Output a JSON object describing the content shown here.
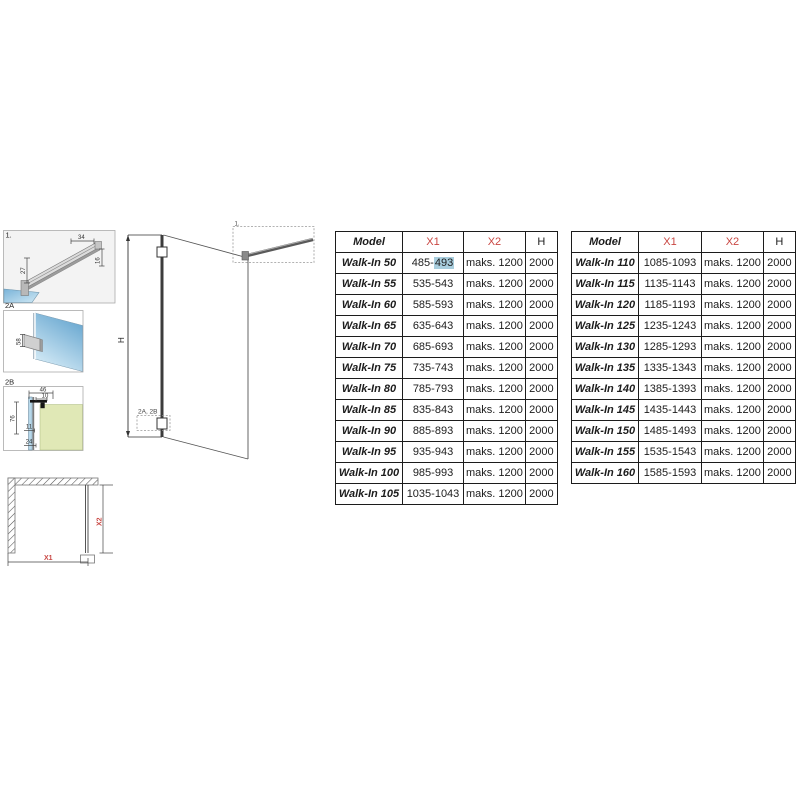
{
  "colors": {
    "dim_red": "#c94743",
    "selection_blue": "#a9cede",
    "glass_dark": "#5f9fca",
    "glass_light": "#d9eef8",
    "wall_green": "#e0e8b6",
    "panel_gray": "#f3f3f3"
  },
  "diagrams": {
    "detail1": {
      "label": "1.",
      "dim_top": "34",
      "dim_right": "16",
      "dim_left": "27"
    },
    "detail2a": {
      "label": "2A",
      "dim": "58"
    },
    "detail2b": {
      "label": "2B",
      "dim_width": "46",
      "dim_offset": "10",
      "dim_height": "76",
      "dim_glass": "11",
      "dim_bottom": "24"
    },
    "elevation": {
      "height_label": "H",
      "callout_top": "1.",
      "callout_bottom": "2A, 2B"
    },
    "plan": {
      "width_label": "X1",
      "depth_label": "X2"
    }
  },
  "tables": [
    {
      "headers": [
        "Model",
        "X1",
        "X2",
        "H"
      ],
      "rows": [
        [
          "Walk-In 50",
          "485-493",
          "maks. 1200",
          "2000"
        ],
        [
          "Walk-In 55",
          "535-543",
          "maks. 1200",
          "2000"
        ],
        [
          "Walk-In 60",
          "585-593",
          "maks. 1200",
          "2000"
        ],
        [
          "Walk-In 65",
          "635-643",
          "maks. 1200",
          "2000"
        ],
        [
          "Walk-In 70",
          "685-693",
          "maks. 1200",
          "2000"
        ],
        [
          "Walk-In 75",
          "735-743",
          "maks. 1200",
          "2000"
        ],
        [
          "Walk-In 80",
          "785-793",
          "maks. 1200",
          "2000"
        ],
        [
          "Walk-In 85",
          "835-843",
          "maks. 1200",
          "2000"
        ],
        [
          "Walk-In 90",
          "885-893",
          "maks. 1200",
          "2000"
        ],
        [
          "Walk-In 95",
          "935-943",
          "maks. 1200",
          "2000"
        ],
        [
          "Walk-In 100",
          "985-993",
          "maks. 1200",
          "2000"
        ],
        [
          "Walk-In 105",
          "1035-1043",
          "maks. 1200",
          "2000"
        ]
      ]
    },
    {
      "headers": [
        "Model",
        "X1",
        "X2",
        "H"
      ],
      "rows": [
        [
          "Walk-In 110",
          "1085-1093",
          "maks. 1200",
          "2000"
        ],
        [
          "Walk-In 115",
          "1135-1143",
          "maks. 1200",
          "2000"
        ],
        [
          "Walk-In 120",
          "1185-1193",
          "maks. 1200",
          "2000"
        ],
        [
          "Walk-In 125",
          "1235-1243",
          "maks. 1200",
          "2000"
        ],
        [
          "Walk-In 130",
          "1285-1293",
          "maks. 1200",
          "2000"
        ],
        [
          "Walk-In 135",
          "1335-1343",
          "maks. 1200",
          "2000"
        ],
        [
          "Walk-In 140",
          "1385-1393",
          "maks. 1200",
          "2000"
        ],
        [
          "Walk-In 145",
          "1435-1443",
          "maks. 1200",
          "2000"
        ],
        [
          "Walk-In 150",
          "1485-1493",
          "maks. 1200",
          "2000"
        ],
        [
          "Walk-In 155",
          "1535-1543",
          "maks. 1200",
          "2000"
        ],
        [
          "Walk-In 160",
          "1585-1593",
          "maks. 1200",
          "2000"
        ]
      ]
    }
  ],
  "selection": {
    "table": 0,
    "row": 0,
    "col": 1,
    "before": "485-",
    "highlighted": "493"
  }
}
